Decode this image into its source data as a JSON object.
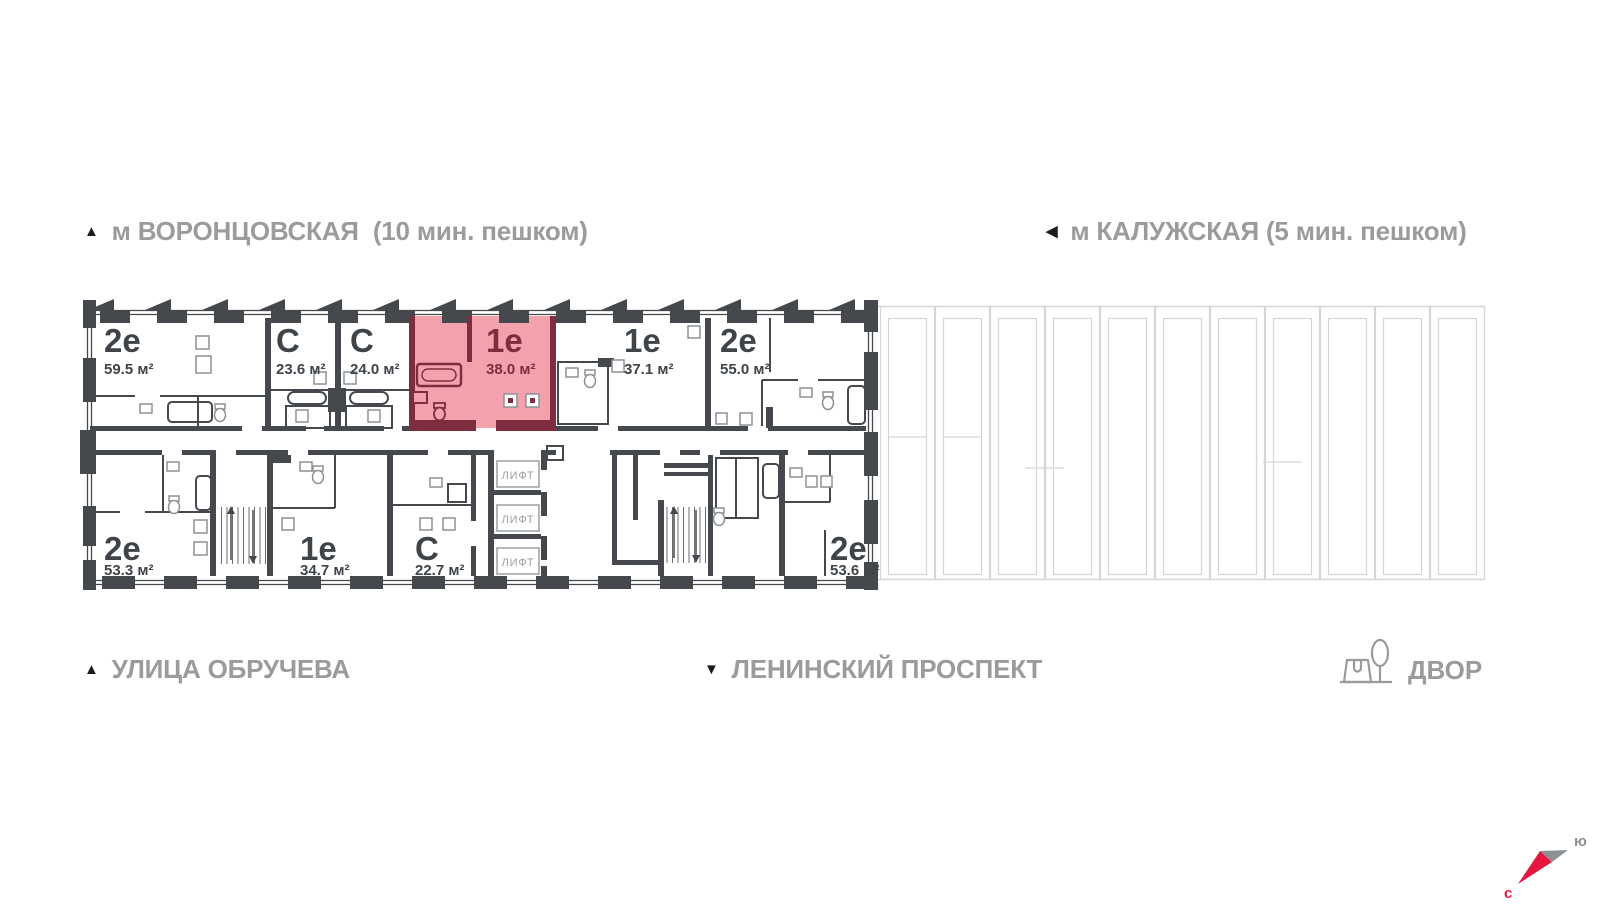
{
  "labels": {
    "metro_left": {
      "icon": "▲",
      "text": "м ВОРОНЦОВСКАЯ  (10 мин. пешком)"
    },
    "metro_right": {
      "icon": "◀",
      "text": "м КАЛУЖСКАЯ (5 мин. пешком)"
    },
    "street_left": {
      "icon": "▲",
      "text": "УЛИЦА ОБРУЧЕВА"
    },
    "street_center": {
      "icon": "▼",
      "text": "ЛЕНИНСКИЙ ПРОСПЕКТ"
    },
    "courtyard": {
      "text": "ДВОР"
    }
  },
  "compass": {
    "north_label": "с",
    "south_label": "ю"
  },
  "floorplan": {
    "elevator_label": "ЛИФТ",
    "apartments": [
      {
        "type": "2е",
        "area": "59.5 м²",
        "row": "top",
        "highlighted": false
      },
      {
        "type": "С",
        "area": "23.6 м²",
        "row": "top",
        "highlighted": false
      },
      {
        "type": "С",
        "area": "24.0 м²",
        "row": "top",
        "highlighted": false
      },
      {
        "type": "1е",
        "area": "38.0 м²",
        "row": "top",
        "highlighted": true
      },
      {
        "type": "1е",
        "area": "37.1 м²",
        "row": "top",
        "highlighted": false
      },
      {
        "type": "2е",
        "area": "55.0 м²",
        "row": "top",
        "highlighted": false
      },
      {
        "type": "2е",
        "area": "53.3 м²",
        "row": "bottom",
        "highlighted": false
      },
      {
        "type": "1е",
        "area": "34.7 м²",
        "row": "bottom",
        "highlighted": false
      },
      {
        "type": "С",
        "area": "22.7 м²",
        "row": "bottom",
        "highlighted": false
      },
      {
        "type": "2е",
        "area": "53.6 м²",
        "row": "bottom",
        "highlighted": false
      }
    ],
    "colors": {
      "wall": "#45494d",
      "label": "#3f4449",
      "highlight_fill": "#f2a1ad",
      "highlight_wall": "#7e2d3e",
      "muted_outline": "#d5d5d5",
      "gray_text": "#9b9b9b",
      "elevator_gray": "#9aa0a4",
      "compass_north": "#e5173f",
      "compass_south": "#8d9093"
    }
  }
}
